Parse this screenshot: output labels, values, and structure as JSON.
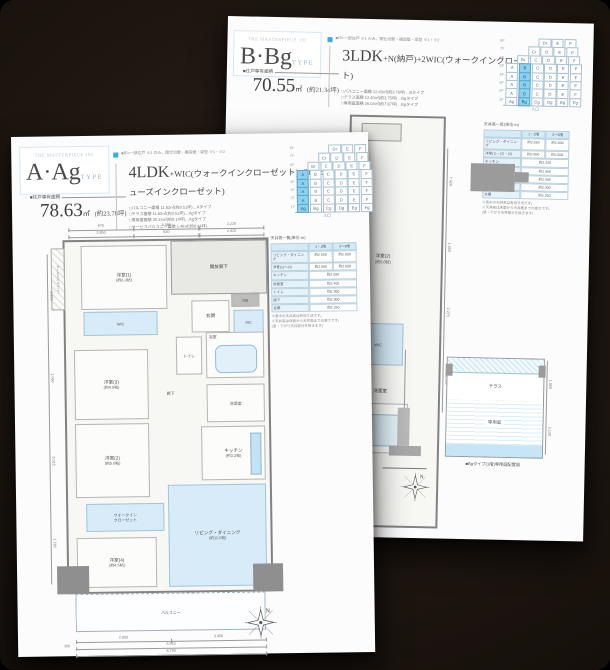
{
  "colors": {
    "accent_blue": "#36ace0",
    "highlight_cell": "#8ed1ee",
    "room_fill": "#d7ecf8",
    "backdrop": "#1a130e"
  },
  "pages": {
    "b": {
      "brand": "THE MASTERPIECE 102",
      "type_name": "B·Bg",
      "type_suffix": "TYPE",
      "legend_text": "■印=一部住戸 ※1 のみ、間仕切壁・構造壁・梁型 ※1・※2",
      "spec_base": "3LDK",
      "spec_rest": "+N(納戸)+2WIC(ウォークインクローゼット)",
      "area_label": "■住戸専有面積",
      "area_value": "70.55",
      "area_unit": "㎡",
      "area_tsubo": "(約21.34坪)",
      "bullets": [
        "□バルコニー面積 12.40㎡(約3.75坪)…Bタイプ",
        "□テラス面積 12.40㎡(約3.75坪)…Bgタイプ",
        "□専用庭面積 26.04㎡(約7.87坪)…Bgタイプ"
      ],
      "grid": {
        "foot": "入口",
        "rows": [
          {
            "floor": "8F",
            "cells": [
              {
                "t": "Dr"
              },
              {
                "t": "E"
              },
              {
                "t": "F"
              }
            ]
          },
          {
            "floor": "7F",
            "cells": [
              {
                "t": "Cr"
              },
              {
                "t": "D"
              },
              {
                "t": "E"
              },
              {
                "t": "F"
              }
            ]
          },
          {
            "floor": "6F",
            "cells": [
              {
                "t": "Br"
              },
              {
                "t": "C"
              },
              {
                "t": "D"
              },
              {
                "t": "E"
              },
              {
                "t": "F"
              }
            ]
          },
          {
            "floor": "5F",
            "cells": [
              {
                "t": "A"
              },
              {
                "t": "B",
                "hl": true
              },
              {
                "t": "C"
              },
              {
                "t": "D"
              },
              {
                "t": "E"
              },
              {
                "t": "F"
              }
            ]
          },
          {
            "floor": "4F",
            "cells": [
              {
                "t": "A"
              },
              {
                "t": "B",
                "hl": true
              },
              {
                "t": "C"
              },
              {
                "t": "D"
              },
              {
                "t": "E"
              },
              {
                "t": "F"
              }
            ]
          },
          {
            "floor": "3F",
            "cells": [
              {
                "t": "A"
              },
              {
                "t": "B",
                "hl": true
              },
              {
                "t": "C"
              },
              {
                "t": "D"
              },
              {
                "t": "E"
              },
              {
                "t": "F"
              }
            ]
          },
          {
            "floor": "2F",
            "cells": [
              {
                "t": "A"
              },
              {
                "t": "B",
                "hl": true
              },
              {
                "t": "C"
              },
              {
                "t": "D"
              },
              {
                "t": "E"
              },
              {
                "t": "F"
              }
            ]
          },
          {
            "floor": "1F",
            "cells": [
              {
                "t": "Ag"
              },
              {
                "t": "Bg",
                "hl": true
              },
              {
                "t": "Cg"
              },
              {
                "t": "Dg"
              },
              {
                "t": "Eg"
              },
              {
                "t": "Fg"
              }
            ]
          }
        ]
      },
      "ceiling": {
        "title": "天井高一覧(単位:m)",
        "h1": "1・2階",
        "h2": "3〜5階",
        "rows": [
          {
            "label": "リビング・ダイニング",
            "v1": "約2.550",
            "v2": "約2.500"
          },
          {
            "label": "洋室(1)・(2)・(3)",
            "v1": "約2.500",
            "v2": "約2.500"
          },
          {
            "label": "キッチン",
            "v1": "約2.200",
            "sp": true
          },
          {
            "label": "洗面室",
            "v1": "約2.400",
            "sp": true
          },
          {
            "label": "トイレ",
            "v1": "約2.300",
            "sp": true
          },
          {
            "label": "納戸",
            "v1": "約2.300",
            "sp": true
          },
          {
            "label": "玄関",
            "v1": "約2.250",
            "sp": true
          }
        ],
        "notes": [
          "※表中の天井高は有効寸法です。",
          "※天井高は床面から天井面までの高さです。",
          "(梁・下がり天井部分を除きます)"
        ]
      },
      "hdim": [
        "3.400"
      ],
      "vdims": [
        "7.420",
        "1.050",
        "2.275",
        "11.390"
      ],
      "rooms": {
        "y2": "洋室(2)",
        "y2s": "(約5.0帖)",
        "wic": "WIC",
        "wash": "洗面室",
        "bath": "浴室"
      },
      "garden": {
        "terrace": "テラス",
        "niwa": "専用庭",
        "caption": "■Bgタイプ(1階)専用庭配置図",
        "dims": [
          "1.060",
          "2.130"
        ]
      },
      "compass_n": "N"
    },
    "a": {
      "brand": "THE MASTERPIECE 102",
      "type_name": "A·Ag",
      "type_suffix": "TYPE",
      "legend_text": "■印=一部住戸 ※1 のみ、間仕切壁・構造壁・梁型 ※1・※2",
      "spec_base": "4LDK",
      "spec_rest": "+WIC(ウォークインクローゼット)+SIC(シューズインクローゼット)",
      "area_label": "■住戸専有面積",
      "area_value": "78.63",
      "area_unit": "㎡",
      "area_tsubo": "(約23.78坪)",
      "bullets": [
        "□バルコニー面積 11.62㎡(約3.51坪)…Aタイプ",
        "□テラス面積 11.62㎡(約3.51坪)…Agタイプ",
        "□専用庭面積 30.24㎡(約9.14坪)…Agタイプ",
        "□サービスバルコニー面積 1.48㎡(約0.44坪)"
      ],
      "grid": {
        "foot": "入口",
        "rows": [
          {
            "floor": "8F",
            "cells": [
              {
                "t": "Dr"
              },
              {
                "t": "E"
              },
              {
                "t": "F"
              }
            ]
          },
          {
            "floor": "7F",
            "cells": [
              {
                "t": "Cr"
              },
              {
                "t": "D"
              },
              {
                "t": "E"
              },
              {
                "t": "F"
              }
            ]
          },
          {
            "floor": "6F",
            "cells": [
              {
                "t": "Br"
              },
              {
                "t": "C"
              },
              {
                "t": "D"
              },
              {
                "t": "E"
              },
              {
                "t": "F"
              }
            ]
          },
          {
            "floor": "5F",
            "cells": [
              {
                "t": "A",
                "hl": true
              },
              {
                "t": "B"
              },
              {
                "t": "C"
              },
              {
                "t": "D"
              },
              {
                "t": "E"
              },
              {
                "t": "F"
              }
            ]
          },
          {
            "floor": "4F",
            "cells": [
              {
                "t": "A",
                "hl": true
              },
              {
                "t": "B"
              },
              {
                "t": "C"
              },
              {
                "t": "D"
              },
              {
                "t": "E"
              },
              {
                "t": "F"
              }
            ]
          },
          {
            "floor": "3F",
            "cells": [
              {
                "t": "A",
                "hl": true
              },
              {
                "t": "B"
              },
              {
                "t": "C"
              },
              {
                "t": "D"
              },
              {
                "t": "E"
              },
              {
                "t": "F"
              }
            ]
          },
          {
            "floor": "2F",
            "cells": [
              {
                "t": "A",
                "hl": true
              },
              {
                "t": "B"
              },
              {
                "t": "C"
              },
              {
                "t": "D"
              },
              {
                "t": "E"
              },
              {
                "t": "F"
              }
            ]
          },
          {
            "floor": "1F",
            "cells": [
              {
                "t": "Ag",
                "hl": true
              },
              {
                "t": "Bg"
              },
              {
                "t": "Cg"
              },
              {
                "t": "Dg"
              },
              {
                "t": "Eg"
              },
              {
                "t": "Fg"
              }
            ]
          }
        ]
      },
      "ceiling": {
        "title": "天井高一覧(単位:m)",
        "h1": "1・2階",
        "h2": "3〜5階",
        "rows": [
          {
            "label": "リビング・ダイニング",
            "v1": "約2.550",
            "v2": "約2.500"
          },
          {
            "label": "洋室(1)〜(4)",
            "v1": "約2.500",
            "v2": "約2.500"
          },
          {
            "label": "キッチン",
            "v1": "約2.200",
            "sp": true
          },
          {
            "label": "洗面室",
            "v1": "約2.400",
            "sp": true
          },
          {
            "label": "トイレ",
            "v1": "約2.300",
            "sp": true
          },
          {
            "label": "廊下",
            "v1": "約2.300",
            "sp": true
          },
          {
            "label": "玄関",
            "v1": "約2.250",
            "sp": true
          }
        ],
        "notes": [
          "※表中の天井高は有効寸法です。",
          "※天井高は床面から天井面までの高さです。",
          "(梁・下がり天井部分を除きます)"
        ]
      },
      "top_dims1": [
        "675",
        "3.385",
        "2.220"
      ],
      "top_dims2": [
        "2.850",
        "830",
        "2.620"
      ],
      "bottom_dims1": [
        "2.850",
        "3.350"
      ],
      "bottom_dims2": [
        "5.915"
      ],
      "bottom_dims3": [
        "6.790"
      ],
      "bottom_small": "300",
      "left_dims": [
        "2.870",
        "1.060",
        "5.915",
        "1.780"
      ],
      "rooms": {
        "y1": "洋室(1)",
        "y1s": "(約6.3帖)",
        "y2": "洋室(2)",
        "y2s": "(約5.0帖)",
        "y3": "洋室(3)",
        "y3s": "(約4.5帖)",
        "y4": "洋室(4)",
        "y4s": "(約4.5帖)",
        "ld": "リビング・ダイニング",
        "lds": "(約11.0帖)",
        "kitchen": "キッチン",
        "kitchens": "(約3.2帖)",
        "genkan": "玄関",
        "toilet": "トイレ",
        "bath": "浴室",
        "wash": "洗面室",
        "hall": "廊下",
        "kaiho": "開放廊下",
        "balcony": "バルコニー",
        "mb": "MB",
        "sic": "SIC",
        "wic": "WIC",
        "wic2a": "ウォークイン",
        "wic2b": "クローゼット",
        "sb": "サービスバルコニー"
      },
      "compass_n": "N"
    }
  }
}
